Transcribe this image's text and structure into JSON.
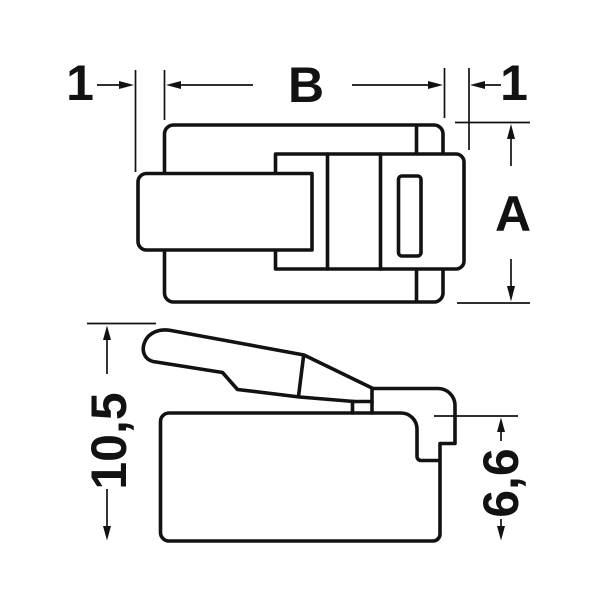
{
  "colors": {
    "background": "#ffffff",
    "line": "#121212"
  },
  "labels": {
    "dim_left_offset": "1",
    "dim_body_length": "B",
    "dim_right_offset": "1",
    "dim_body_width": "A",
    "dim_overall_height": "10,5",
    "dim_front_height": "6,6"
  }
}
